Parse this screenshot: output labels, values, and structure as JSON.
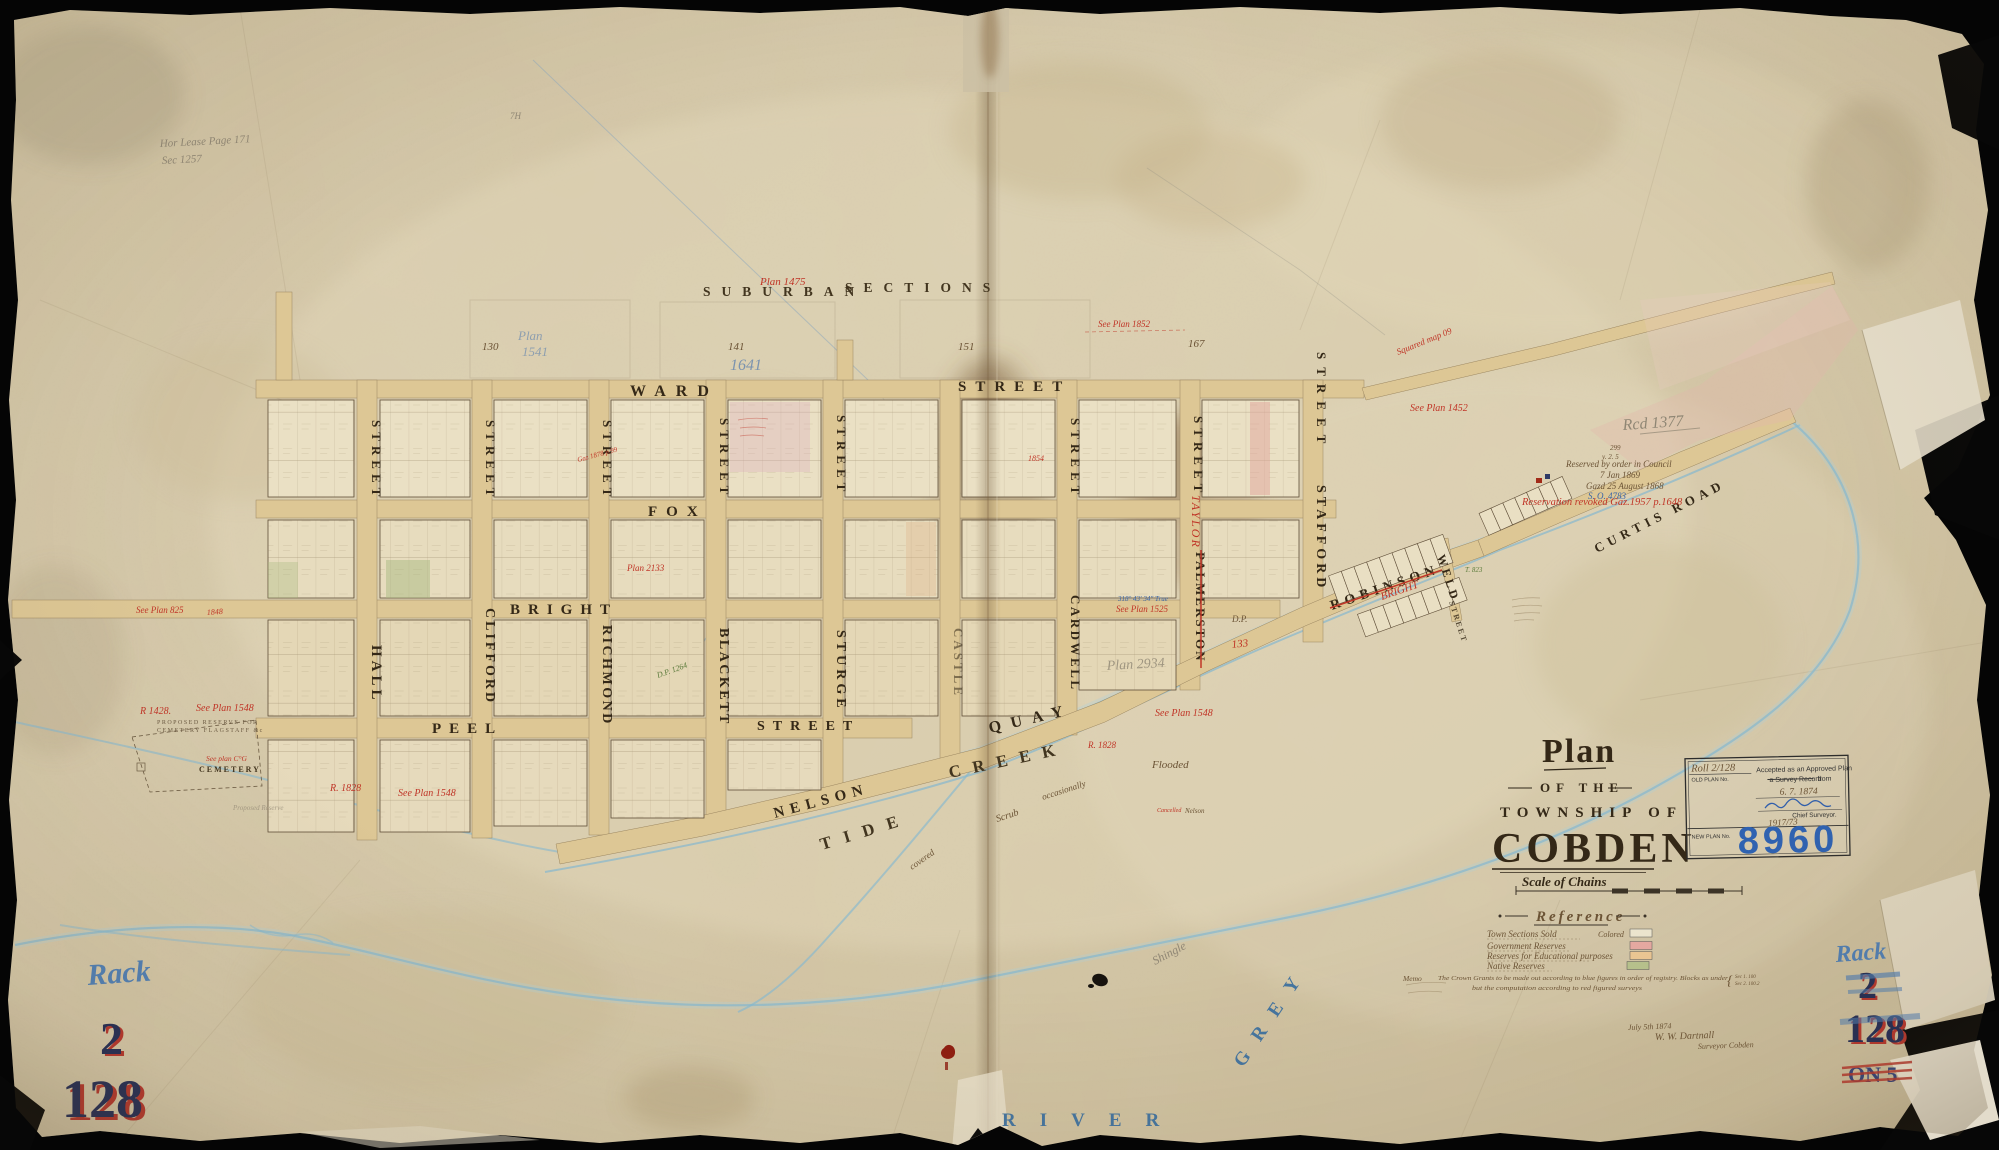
{
  "title_block": {
    "plan": "Plan",
    "of_the": "OF THE",
    "township_of": "TOWNSHIP OF",
    "name": "COBDEN",
    "scale": "Scale of Chains"
  },
  "stamp": {
    "old_value": "Roll 2/128",
    "old_label": "OLD PLAN No.",
    "accepted1": "Accepted as an Approved Plan",
    "accepted2": "a Survey Record",
    "accepted3": "from",
    "date": "6. 7. 1874",
    "chief": "Chief Surveyor.",
    "file_no": "1917/73",
    "new_label": "NEW PLAN No.",
    "new_value": "8960",
    "new_value_color": "#2d62b4"
  },
  "reference": {
    "heading": "Reference",
    "colored": "Colored",
    "rows": [
      {
        "label": "Town Sections Sold",
        "color": "#efe9d2"
      },
      {
        "label": "Government Reserves",
        "color": "#e9aba4"
      },
      {
        "label": "Reserves for Educational purposes",
        "color": "#eec996"
      },
      {
        "label": "Native Reserves",
        "color": "#b9c48f"
      }
    ],
    "memo_label": "Memo",
    "memo1": "The Crown Grants to be made out according to blue figures in order of registry.  Blocks as under",
    "memo2": "but the computation according to red figured surveys",
    "bracket1": "Sec 1. 100",
    "bracket2": "Sec 2. 100.2"
  },
  "signoff": {
    "date": "July 5th 1874",
    "name": "W. W. Dartnall",
    "role": "Surveyor Cobden"
  },
  "corner_marks": {
    "rack": "Rack",
    "shelf": "2",
    "plan": "128",
    "on5": "ON 5"
  },
  "suburban": {
    "word1": "SUBURBAN",
    "word2": "SECTIONS",
    "plan_ref": "Plan 1475",
    "blocks": [
      "130",
      "141",
      "151",
      "167"
    ],
    "pencil_1641": "1641",
    "pencil_plan": "Plan",
    "pencil_1541": "1541"
  },
  "streets": {
    "ward": "WARD",
    "fox": "FOX",
    "bright": "BRIGHT",
    "peel": "PEEL",
    "nelson": "NELSON",
    "street": "STREET",
    "hall": "HALL",
    "clifford": "CLIFFORD",
    "richmond": "RICHMOND",
    "blackett": "BLACKETT",
    "sturge": "STURGE",
    "castle": "CASTLE",
    "quay": "QUAY",
    "cardwell": "CARDWELL",
    "palmerston": "PALMERSTON",
    "taylor": "TAYLOR",
    "stafford": "STAFFORD",
    "robinson": "ROBINSON",
    "bright_red": "BRIGHT",
    "weld": "WELD",
    "curtis": "CURTIS ROAD"
  },
  "water": {
    "tide": "TIDE",
    "creek": "CREEK",
    "river": "RIVER",
    "grey": "GREY",
    "shingle": "Shingle",
    "scrub": "Scrub",
    "occasionally": "occasionally",
    "covered": "covered",
    "flooded": "Flooded"
  },
  "annotations": {
    "plan1475_note": "Plan 1475",
    "plan1852": "See Plan 1852",
    "squared": "Squared map 09",
    "plan1452": "See Plan 1452",
    "plan825": "See Plan 825",
    "n1848": "1848",
    "r1428": "R 1428.",
    "plan1548": "See Plan 1548",
    "cg": "See plan C°G",
    "r1828": "R. 1828",
    "plan1525": "See Plan 1525",
    "bearing": "318° 43′ 34″ True",
    "plan2133": "Plan 2133",
    "gaz1878": "Gaz 1878 p.99",
    "n1854": "1854",
    "dp": "D.P.",
    "n133": "133",
    "dp1264": "D.P. 1264",
    "t823": "T. 823",
    "revoked": "Reservation revoked Gaz.1957 p.1648",
    "n299": "299",
    "y25": "y. 2. 5",
    "reserved1": "Reserved by order in Council",
    "reserved2": "7 Jan 1869",
    "reserved3": "Gazd 25 August 1868",
    "so": "S. O. 4783",
    "rcd": "Rcd 1377",
    "cancelled": "Cancelled",
    "nelson_small": "Nelson",
    "cemetery": "CEMETERY",
    "prop1": "PROPOSED RESERVE FOR",
    "prop2": "CEMETERY FLAGSTAFF &c",
    "proposed_reserve": "Proposed Reserve",
    "lease1": "Hor Lease Page 171",
    "lease2": "Sec 1257",
    "plan2934": "Plan 2934",
    "th": "7H"
  }
}
